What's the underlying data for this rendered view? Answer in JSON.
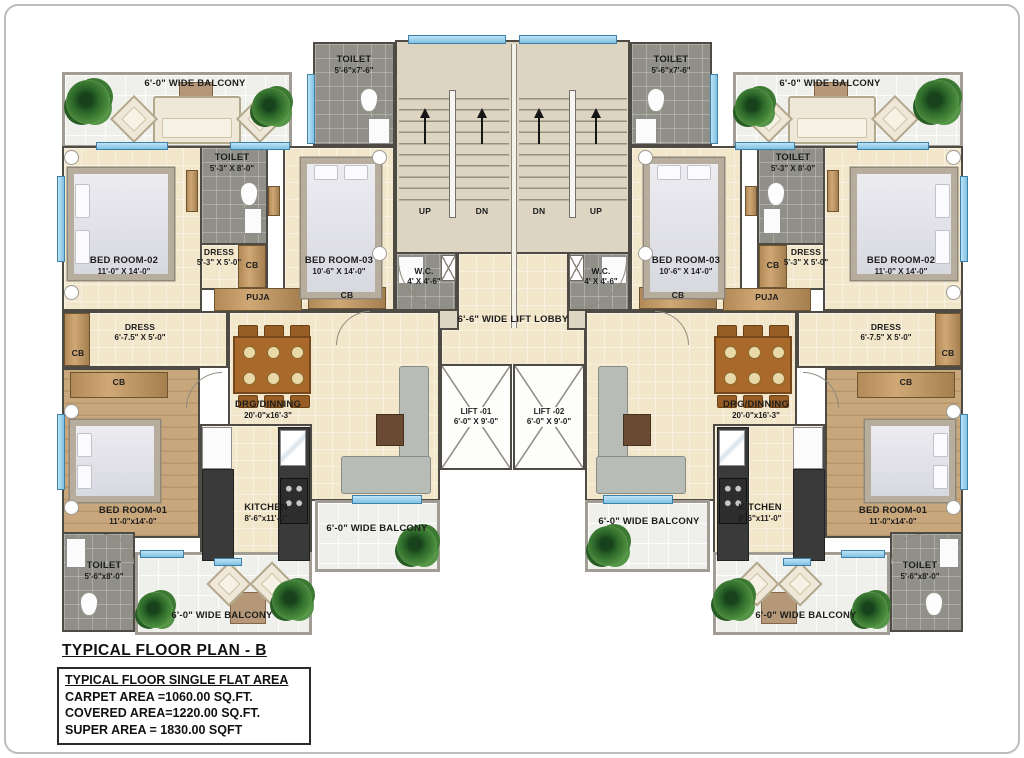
{
  "palette": {
    "wall": "#4e4a44",
    "floor_beige": "#f2e6cb",
    "floor_wood": "#c8a77c",
    "floor_toilet": "#908f88",
    "floor_balcony": "#eff0ec",
    "floor_stairs": "#ddd5c2",
    "window_blue": "#8ecbe9"
  },
  "title": "TYPICAL FLOOR PLAN - B",
  "area_box": {
    "heading": "TYPICAL FLOOR SINGLE FLAT AREA",
    "carpet": "CARPET AREA   =1060.00 SQ.FT.",
    "covered": "COVERED AREA=1220.00 SQ.FT.",
    "super": "SUPER AREA  =  1830.00 SQFT"
  },
  "labels": {
    "balcony": "6'-0\" WIDE BALCONY",
    "lift_lobby": "6'-6\" WIDE LIFT LOBBY",
    "up": "UP",
    "dn": "DN",
    "cb": "CB",
    "puja": "PUJA",
    "bedroom1": {
      "name": "BED ROOM-01",
      "dims": "11'-0\"x14'-0\""
    },
    "bedroom2": {
      "name": "BED ROOM-02",
      "dims": "11'-0\" X 14'-0\""
    },
    "bedroom3": {
      "name": "BED ROOM-03",
      "dims": "10'-6\" X 14'-0\""
    },
    "toilet_top": {
      "name": "TOILET",
      "dims": "5'-6\"x7'-6\""
    },
    "toilet_master": {
      "name": "TOILET",
      "dims": "5'-3\" X 8'-0\""
    },
    "toilet_bed1": {
      "name": "TOILET",
      "dims": "5'-6\"x8'-0\""
    },
    "dress_master": {
      "name": "DRESS",
      "dims": "5'-3\" X 5'-0\""
    },
    "dress_bed1": {
      "name": "DRESS",
      "dims": "6'-7.5\" X 5'-0\""
    },
    "wc": {
      "name": "W.C.",
      "dims": "4' X 4'-6\""
    },
    "drg_dinning": {
      "name": "DRG/DINNING",
      "dims": "20'-0\"x16'-3\""
    },
    "kitchen": {
      "name": "KITCHEN",
      "dims": "8'-6\"x11'-0\""
    },
    "lift1": {
      "name": "LIFT -01",
      "dims": "6'-0\" X 9'-0\""
    },
    "lift2": {
      "name": "LIFT -02",
      "dims": "6'-0\" X 9'-0\""
    }
  }
}
